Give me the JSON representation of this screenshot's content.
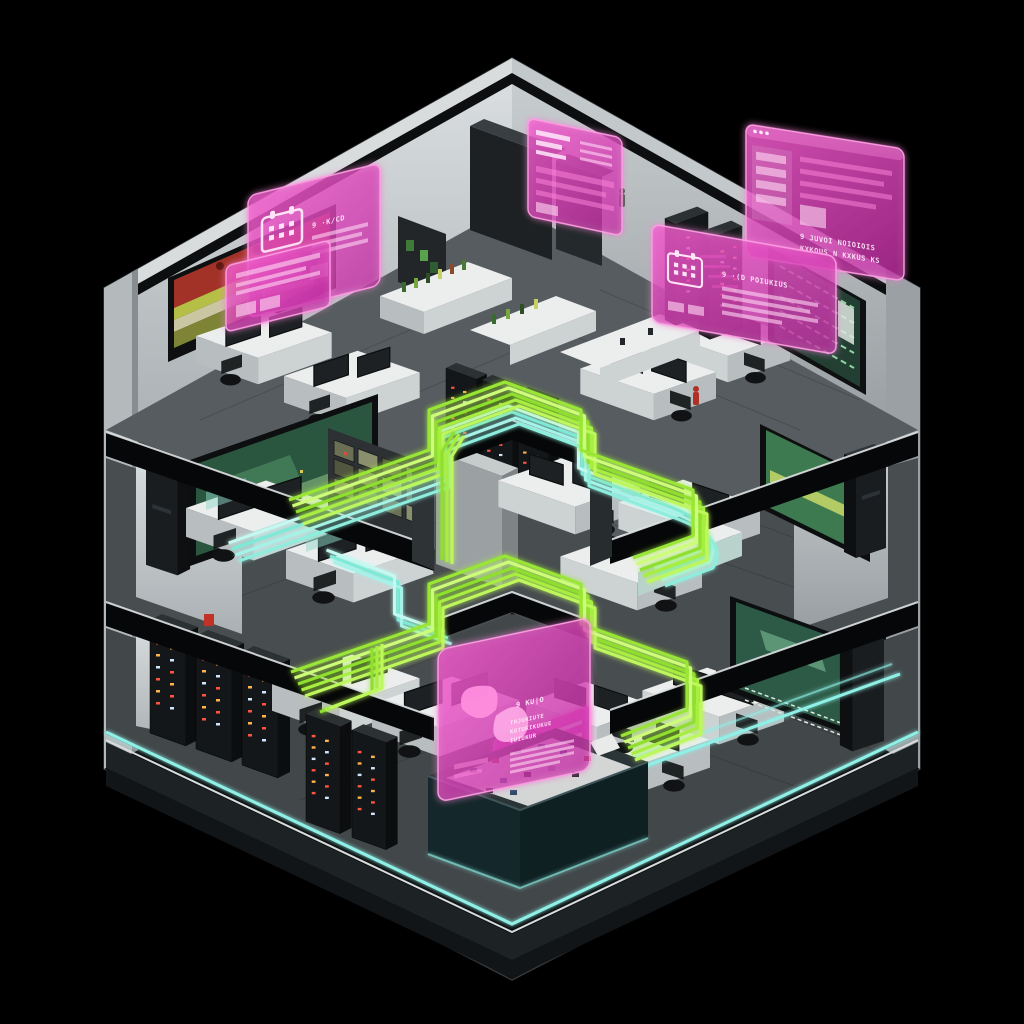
{
  "scene": {
    "type": "isometric-cutaway-building-render",
    "colors": {
      "background": "#000000",
      "neon_cyan": "#8ef0e6",
      "neon_cyan_bright": "#c8fbf5",
      "neon_green": "#a9ee3c",
      "neon_green_bright": "#c3f85e",
      "holo_pink": "#e44fc4",
      "holo_pink_bright": "#ff9ae4",
      "wall_light": "#d8dcdd",
      "wall_mid": "#a8aeb1",
      "slab_dark": "#060708",
      "floor_gray": "#4a5053",
      "plinth_dark": "#1d2224",
      "rack_led_red": "#ff5440",
      "rack_led_amber": "#ffb14a",
      "screen_green": "#3d7a4f",
      "tv_yellow_green": "#b6bf45",
      "tv_red": "#a23127",
      "pit_teal": "#14272a"
    },
    "panels": {
      "top_left_calendar": {
        "icon": "calendar-icon",
        "title": "9 ·K/CD"
      },
      "top_center": {
        "icon": "document-rows"
      },
      "top_right_window": {
        "icon": "browser-window",
        "line1": "9 JUVOI NOIOIOIS",
        "line2": "KXKOUS N KXKUS KS"
      },
      "right_calendar": {
        "icon": "calendar-icon",
        "title": "9 ·(D POIUKIUS"
      },
      "bottom_butterfly": {
        "icon": "butterfly-icon",
        "title": "9 KU|O",
        "line1": "THJUKIUTE",
        "line2": "KOTUKIKUKUE",
        "line3": "IUIUKUR"
      },
      "pit_backdrop": {
        "icon": "striped-panel"
      }
    }
  }
}
